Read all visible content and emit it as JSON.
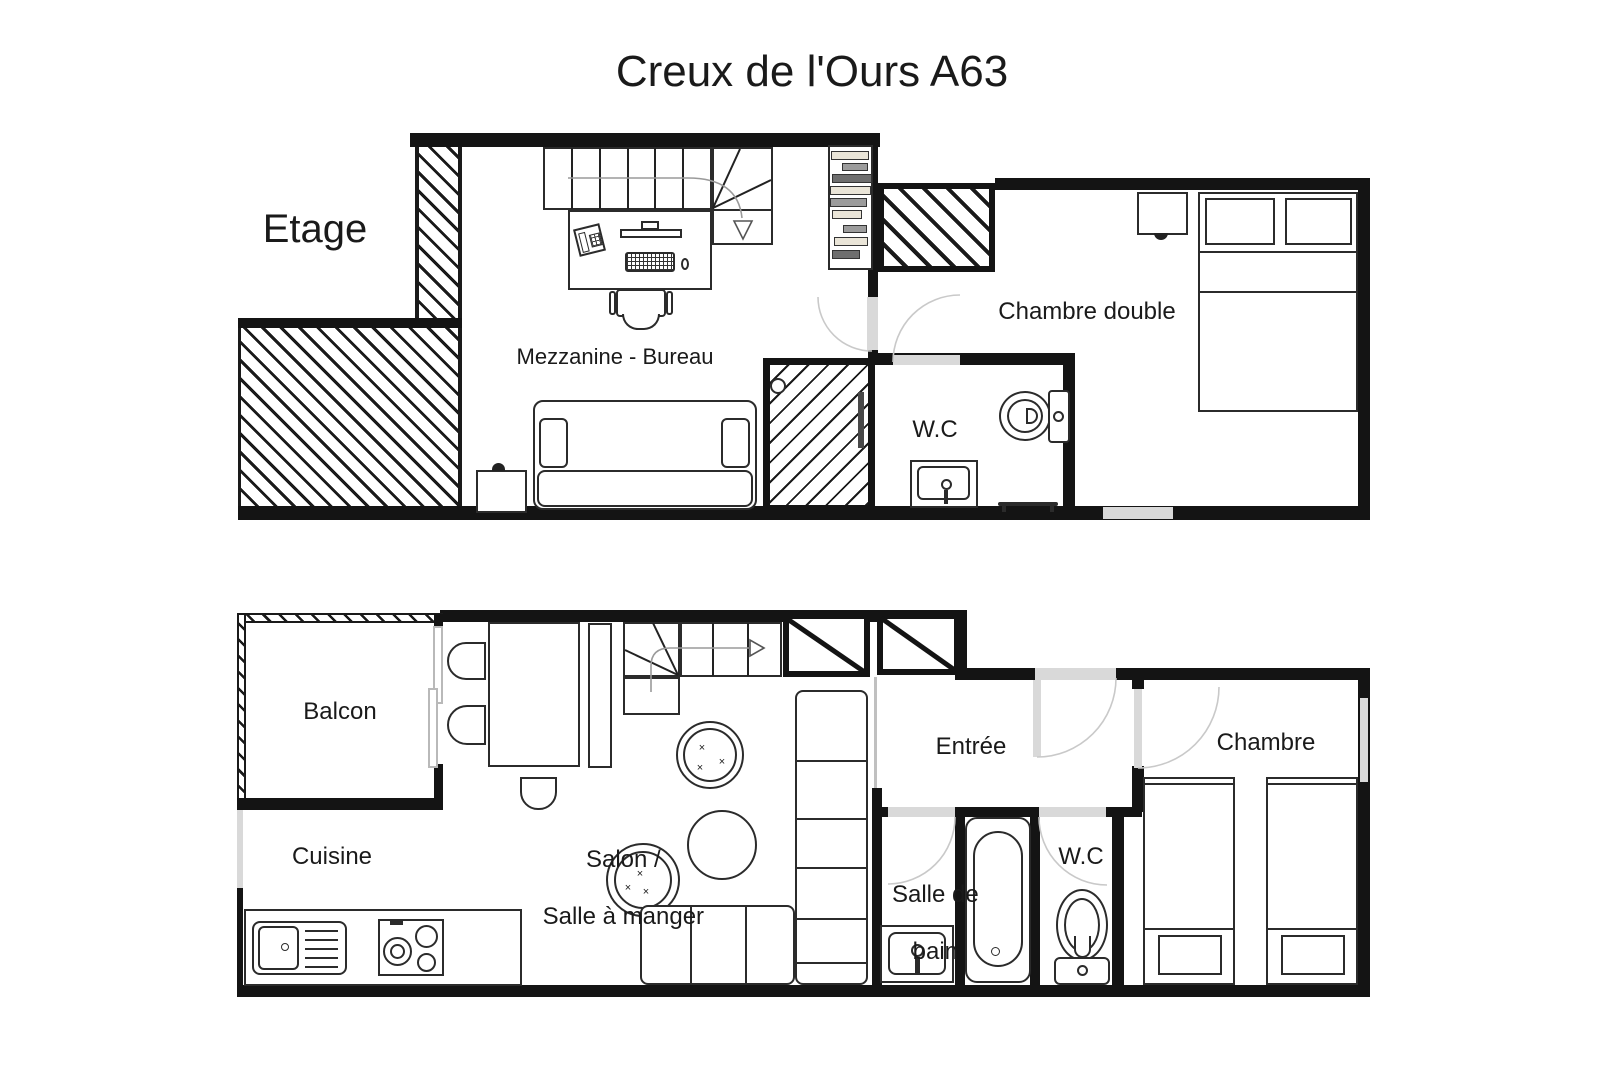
{
  "title": "Creux de l'Ours A63",
  "floors": {
    "upper": {
      "label": "Etage",
      "rooms": {
        "mezzanine": "Mezzanine - Bureau",
        "chambre_double": "Chambre double",
        "wc": "W.C"
      }
    },
    "lower": {
      "rooms": {
        "balcon": "Balcon",
        "cuisine": "Cuisine",
        "salon_line1": "Salon /",
        "salon_line2": "Salle à manger",
        "entree": "Entrée",
        "salle_de_bain_line1": "Salle de",
        "salle_de_bain_line2": "bain",
        "wc": "W.C",
        "chambre": "Chambre"
      }
    }
  },
  "colors": {
    "ink": "#1a1a1a",
    "wall": "#141414",
    "stroke": "#2b2b2b",
    "door": "#d9d9d9",
    "arc": "#c9c9c9",
    "shelf-beige": "#eae5d8",
    "shelf-gray": "#9c9c9c",
    "shelf-dark": "#6e6e6e"
  }
}
